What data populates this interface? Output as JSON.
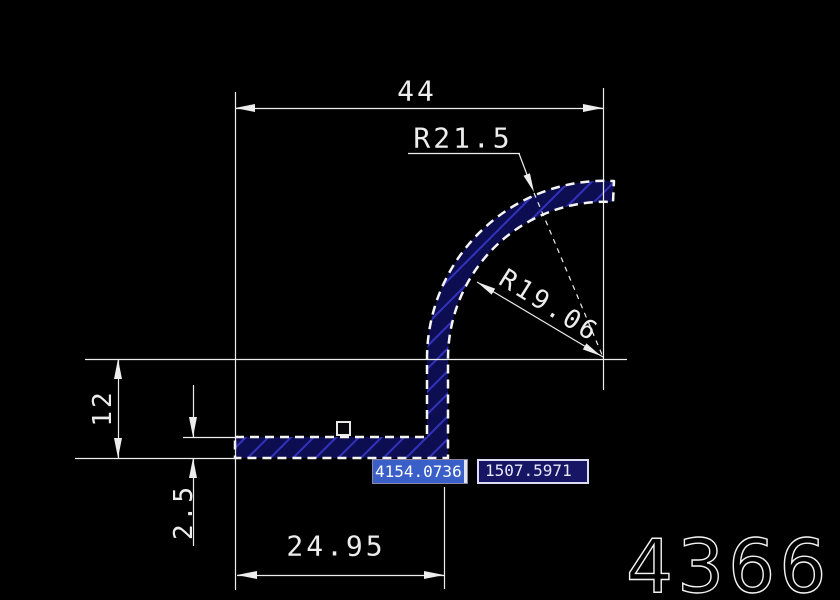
{
  "canvas": {
    "background": "#000000",
    "line_color": "#ededed",
    "profile_fill": "#0d0d52",
    "hatch_color": "#3232bc",
    "selection_highlight": "#3a5fc8",
    "input_box_fill": "#161664"
  },
  "dimensions": {
    "top_width": "44",
    "outer_radius": "R21.5",
    "inner_radius": "R19.06",
    "left_height": "12",
    "thickness": "2.5",
    "bottom_width": "24.95"
  },
  "dynamic_input": {
    "x_value": "4154.0736",
    "x_selected": true,
    "y_value": "1507.5971"
  },
  "drawing_number": "4366"
}
